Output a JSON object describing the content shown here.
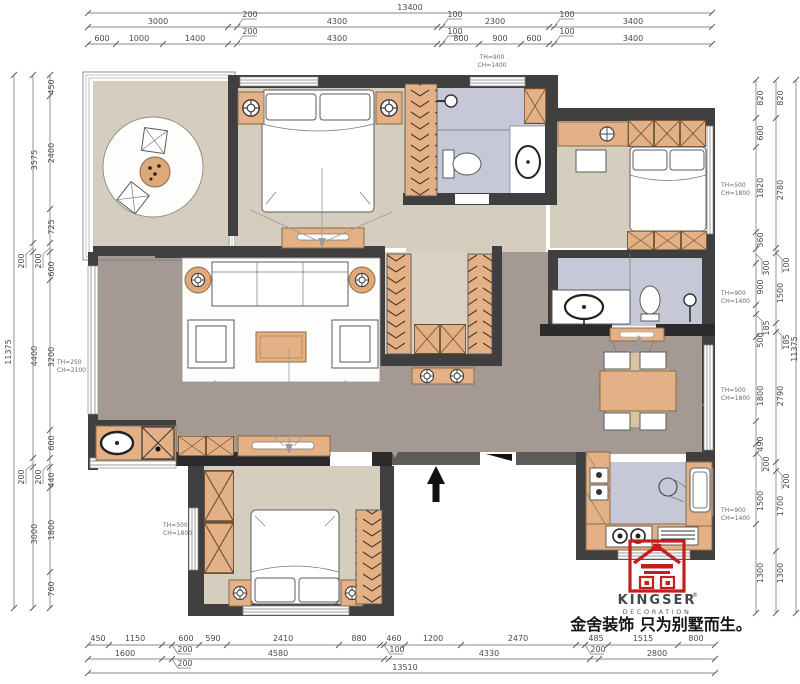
{
  "dims": {
    "top": {
      "overall": "13400",
      "row2": [
        "3000",
        "200",
        "4300",
        "100",
        "2300",
        "100",
        "3400"
      ],
      "row3": [
        "600",
        "1000",
        "1400",
        "200",
        "4300",
        "100",
        "800",
        "900",
        "600",
        "100",
        "3400"
      ]
    },
    "bottom": {
      "row1": [
        "450",
        "1150",
        "200",
        "600",
        "590",
        "2410",
        "880",
        "100",
        "460",
        "1200",
        "2470",
        "200",
        "485",
        "1515",
        "800"
      ],
      "row2": [
        "1600",
        "200",
        "4580",
        "100",
        "4330",
        "200",
        "2800"
      ],
      "overall": "13510"
    },
    "left": {
      "overall": "11375",
      "mid": [
        "3575",
        "200",
        "4400",
        "200",
        "3000"
      ],
      "inner": [
        "450",
        "2400",
        "725",
        "200",
        "600",
        "3200",
        "600",
        "200",
        "440",
        "1800",
        "760"
      ]
    },
    "right": {
      "overall": "11375",
      "mid": [
        "820",
        "2780",
        "100",
        "1500",
        "185",
        "2790",
        "200",
        "1700",
        "1300"
      ],
      "inner": [
        "820",
        "600",
        "1820",
        "360",
        "300",
        "900",
        "185",
        "500",
        "1800",
        "490",
        "200",
        "1500",
        "1300"
      ]
    }
  },
  "annotations": {
    "top": {
      "l1": "TH=900",
      "l2": "CH=1400"
    },
    "right1": {
      "l1": "TH=500",
      "l2": "CH=1800"
    },
    "right2": {
      "l1": "TH=900",
      "l2": "CH=1400"
    },
    "right3": {
      "l1": "TH=500",
      "l2": "CH=1800"
    },
    "right4": {
      "l1": "TH=900",
      "l2": "CH=1400"
    },
    "left_living": {
      "l1": "TH=250",
      "l2": "CH=2100"
    },
    "left_bedroom": {
      "l1": "TH=500",
      "l2": "CH=1800"
    }
  },
  "logo": {
    "brand": "KINGSER",
    "reg": "®",
    "division": "DECORATION",
    "tagline": "金舍装饰 只为别墅而生。"
  },
  "colors": {
    "wall": "#3f3f3f",
    "floor_beige": "#d5cdbd",
    "floor_gray": "#a59a93",
    "floor_lavender": "#c6c8d7",
    "furniture_tan": "#e3b185",
    "logo_red": "#c41e1e"
  }
}
